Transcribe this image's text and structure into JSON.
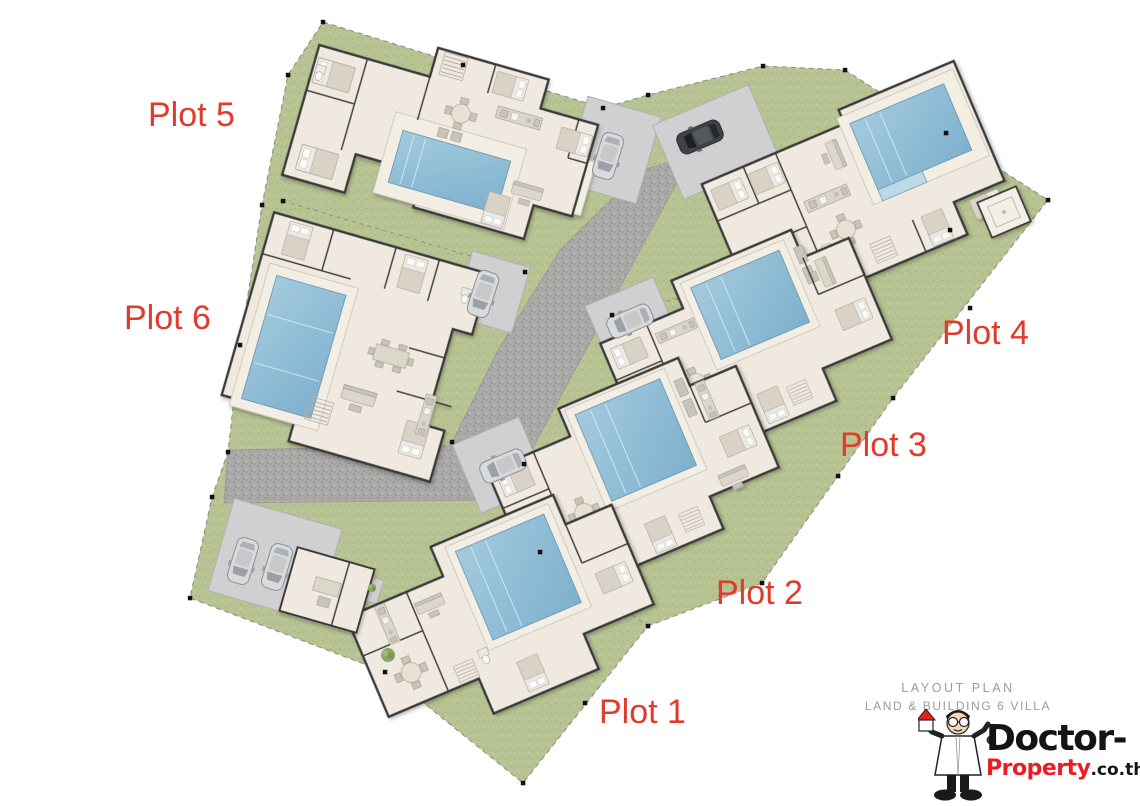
{
  "plan": {
    "type": "site layout plan",
    "villa_count": 6
  },
  "plots": [
    {
      "label": "Plot 1"
    },
    {
      "label": "Plot 2"
    },
    {
      "label": "Plot 3"
    },
    {
      "label": "Plot 4"
    },
    {
      "label": "Plot 5"
    },
    {
      "label": "Plot 6"
    }
  ],
  "title_block": {
    "line1": "LAYOUT PLAN",
    "line2": "LAND & BUILDING 6 VILLA"
  },
  "logo": {
    "brand_black": "Doctor-",
    "brand_red": "Property",
    "brand_suffix": ".co.th"
  },
  "icons": {
    "car": "car-icon",
    "pool": "swimming-pool",
    "shrub": "shrub-icon",
    "doctor": "doctor-mascot-icon",
    "house": "house-icon",
    "survey_marker": "survey-marker-icon"
  },
  "colors": {
    "label_red": "#e03b2c",
    "title_gray": "#9b9b9b",
    "logo_black": "#141414",
    "logo_red": "#ec1c24",
    "grass": "#b7c392",
    "road": "#a9a8a6",
    "concrete": "#d0d0d2",
    "floor": "#efe9df",
    "wall": "#3a3a3a",
    "deck": "#f2eee4",
    "pool": "#a3cade",
    "pool_deep": "#7eb0cd",
    "furniture": "#dcd7cb",
    "car_silver": "#d9dadc",
    "car_dark": "#3f4347",
    "marker": "#111111"
  }
}
